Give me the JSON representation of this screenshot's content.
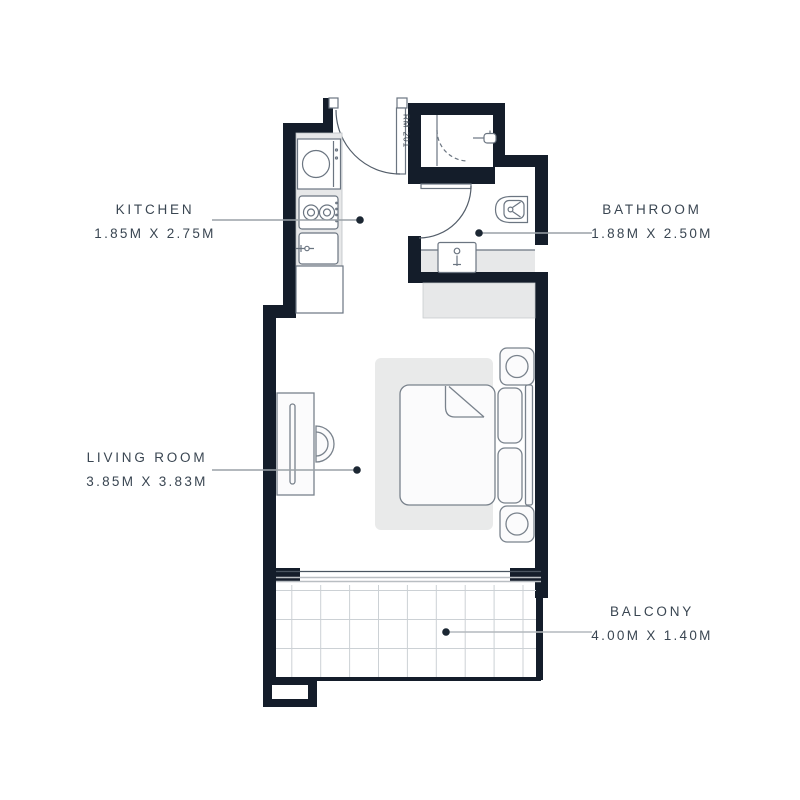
{
  "floor_plan": {
    "unit_door_label": "RM 201",
    "rooms": [
      {
        "name": "KITCHEN",
        "dimensions": "1.85M X 2.75M"
      },
      {
        "name": "BATHROOM",
        "dimensions": "1.88M X 2.50M"
      },
      {
        "name": "LIVING ROOM",
        "dimensions": "3.85M X 3.83M"
      },
      {
        "name": "BALCONY",
        "dimensions": "4.00M X 1.40M"
      }
    ],
    "colors": {
      "wall": "#141d2a",
      "fixture_outline": "#6b7581",
      "surface_fill": "#e7e8e9",
      "tile_line": "#ccd1d5",
      "label_text": "#3a4652",
      "leader_line": "#9aa1a7",
      "leader_dot": "#1c2733",
      "background": "#ffffff"
    }
  }
}
